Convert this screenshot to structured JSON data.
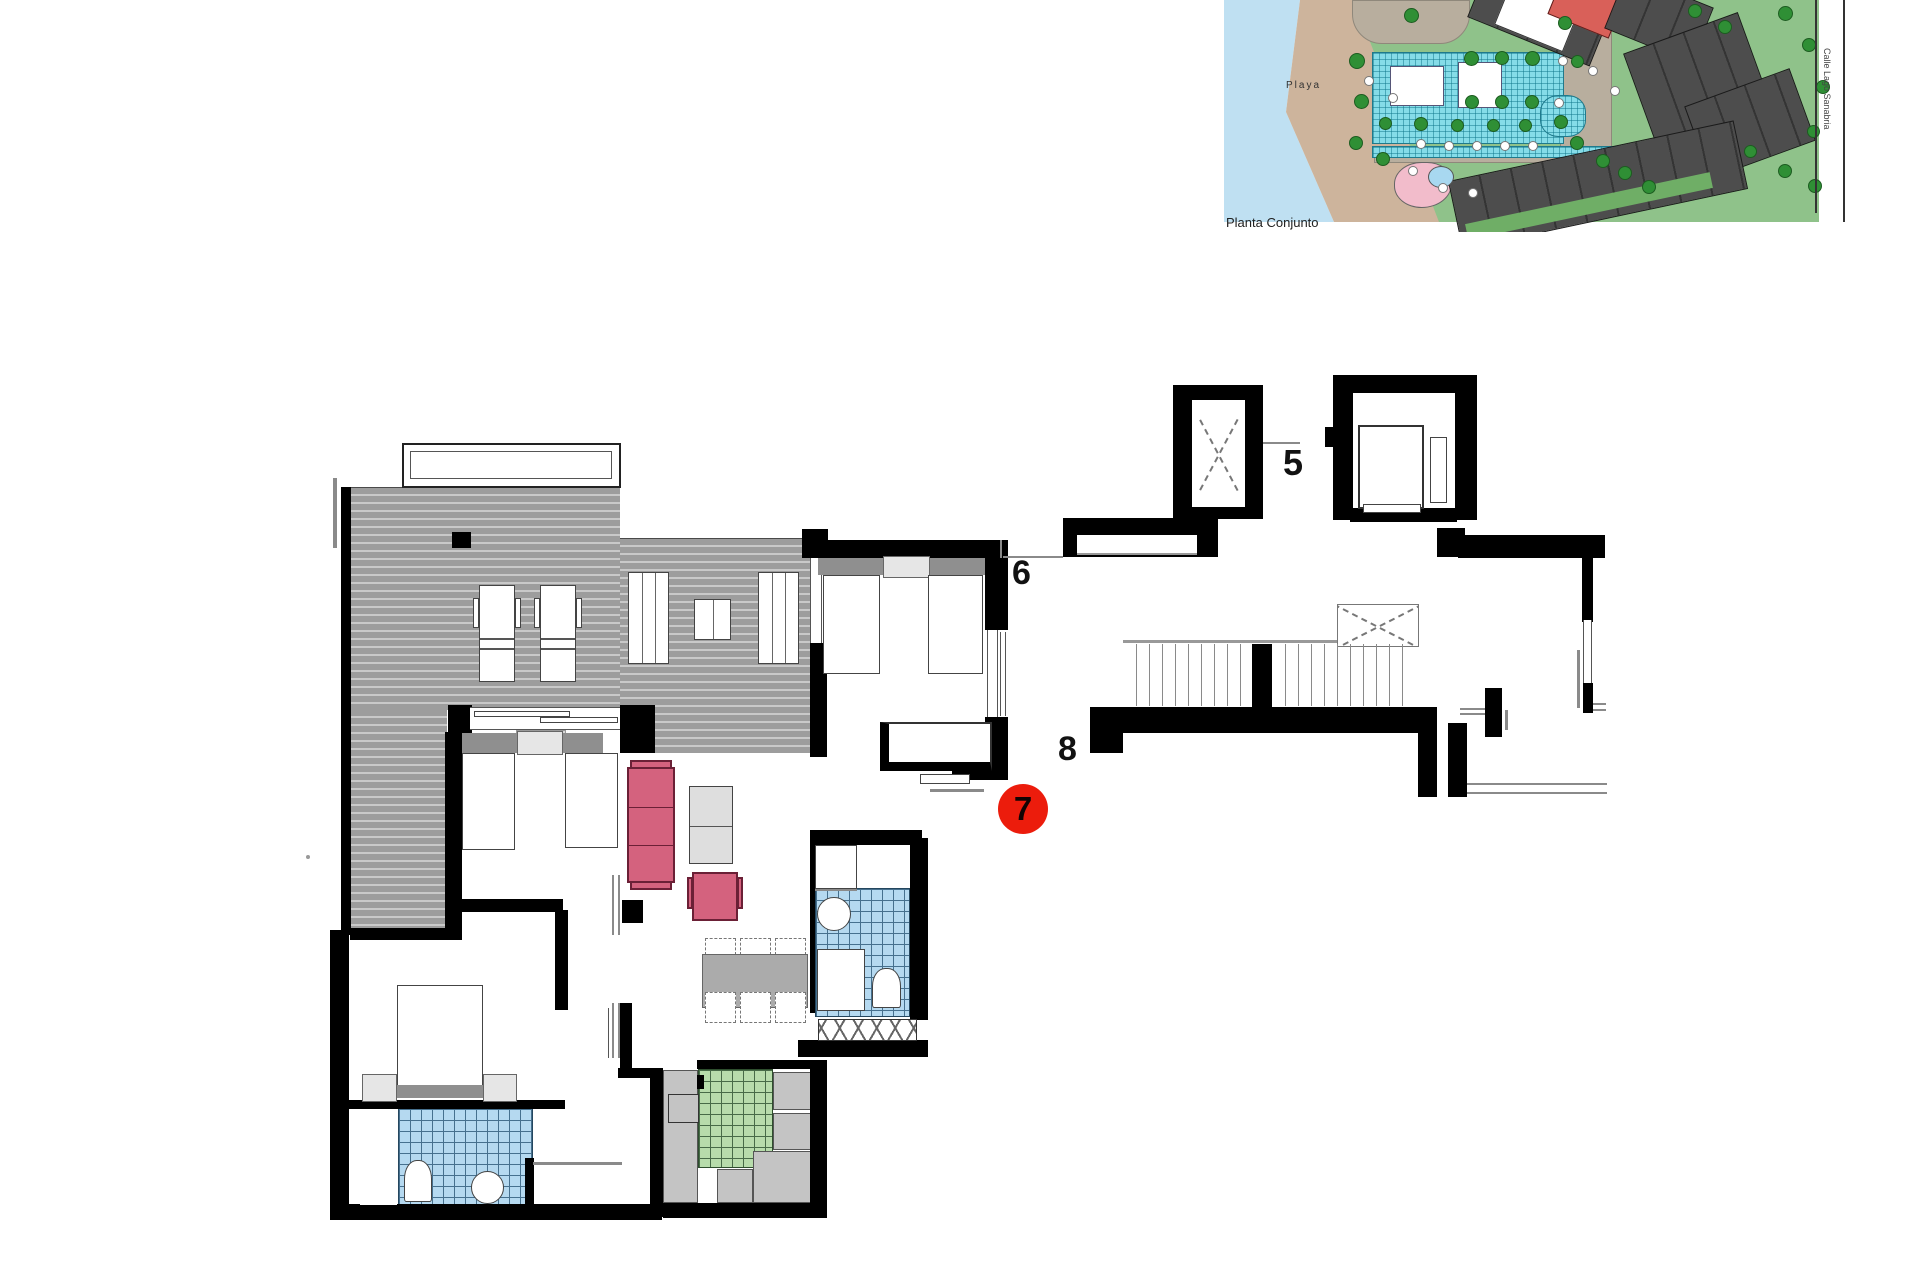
{
  "site_plan": {
    "caption": "Planta Conjunto",
    "beach_label": "Playa",
    "street_label": "Calle Lago Sanabria"
  },
  "floor_plan": {
    "stair_core_label": "5",
    "landing_label_top": "6",
    "unit_badge": "7",
    "landing_label_mid": "8"
  },
  "colors": {
    "wall": "#000000",
    "badge_red": "#ec1c0c",
    "terrace_deck": "#9d9d9d",
    "bath_tile": "#b5d9f0",
    "kitchen_tile": "#b7dcab",
    "sofa_pink": "#d4627e",
    "water": "#bfe0f2",
    "sand": "#cdb49c",
    "grass": "#8fc28a",
    "pool": "#85dce8",
    "building_gray": "#4d4d4d",
    "building_red": "#d96059",
    "kids_pool_pink": "#f2bccb"
  }
}
